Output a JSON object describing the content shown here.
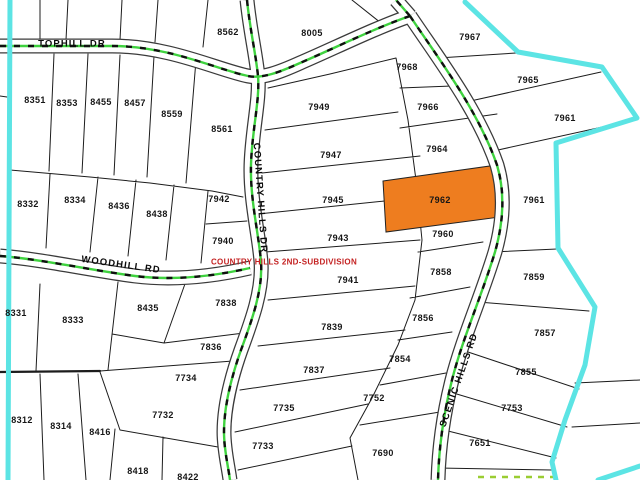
{
  "map": {
    "background_color": "#ffffff",
    "parcel_line_color": "#1c1c1c",
    "road_fill_color": "#ffffff",
    "road_centerline_color": "#3fd23f",
    "boundary_color": "#5ce4e4",
    "highlight_color": "#ee7d1f",
    "highlighted_parcel": "7962",
    "subdivision_label": {
      "text": "COUNTRY HILLS 2ND-SUBDIVISION",
      "color": "#c42222"
    },
    "roads": [
      {
        "name": "TOPHILL DR",
        "label_x": 72,
        "label_y": 44,
        "angle": 0
      },
      {
        "name": "WOODHILL RD",
        "label_x": 121,
        "label_y": 265,
        "angle": 8
      },
      {
        "name": "COUNTRY HILLS DR",
        "label_x": 260,
        "label_y": 198,
        "angle": 86
      },
      {
        "name": "SCENIC HILLS RD",
        "label_x": 459,
        "label_y": 380,
        "angle": -71
      }
    ],
    "parcels": [
      {
        "id": "8351",
        "x": 35,
        "y": 100
      },
      {
        "id": "8353",
        "x": 67,
        "y": 103
      },
      {
        "id": "8455",
        "x": 101,
        "y": 102
      },
      {
        "id": "8457",
        "x": 135,
        "y": 103
      },
      {
        "id": "8559",
        "x": 172,
        "y": 114
      },
      {
        "id": "8561",
        "x": 222,
        "y": 129
      },
      {
        "id": "8562",
        "x": 228,
        "y": 32
      },
      {
        "id": "8005",
        "x": 312,
        "y": 33
      },
      {
        "id": "7967",
        "x": 470,
        "y": 37
      },
      {
        "id": "7968",
        "x": 407,
        "y": 67
      },
      {
        "id": "7966",
        "x": 428,
        "y": 107
      },
      {
        "id": "7965",
        "x": 528,
        "y": 80
      },
      {
        "id": "7964",
        "x": 437,
        "y": 149
      },
      {
        "id": "7961",
        "x": 565,
        "y": 118
      },
      {
        "id": "7962",
        "x": 440,
        "y": 200
      },
      {
        "id": "7961",
        "x": 534,
        "y": 200
      },
      {
        "id": "7960",
        "x": 443,
        "y": 234
      },
      {
        "id": "7949",
        "x": 319,
        "y": 107
      },
      {
        "id": "7947",
        "x": 331,
        "y": 155
      },
      {
        "id": "7945",
        "x": 333,
        "y": 200
      },
      {
        "id": "7943",
        "x": 338,
        "y": 238
      },
      {
        "id": "7941",
        "x": 348,
        "y": 280
      },
      {
        "id": "7942",
        "x": 219,
        "y": 199
      },
      {
        "id": "7940",
        "x": 223,
        "y": 241
      },
      {
        "id": "8332",
        "x": 28,
        "y": 204
      },
      {
        "id": "8334",
        "x": 75,
        "y": 200
      },
      {
        "id": "8436",
        "x": 119,
        "y": 206
      },
      {
        "id": "8438",
        "x": 157,
        "y": 214
      },
      {
        "id": "8331",
        "x": 16,
        "y": 313
      },
      {
        "id": "8333",
        "x": 73,
        "y": 320
      },
      {
        "id": "8435",
        "x": 148,
        "y": 308
      },
      {
        "id": "7838",
        "x": 226,
        "y": 303
      },
      {
        "id": "7836",
        "x": 211,
        "y": 347
      },
      {
        "id": "7734",
        "x": 186,
        "y": 378
      },
      {
        "id": "7732",
        "x": 163,
        "y": 415
      },
      {
        "id": "8312",
        "x": 22,
        "y": 420
      },
      {
        "id": "8314",
        "x": 61,
        "y": 426
      },
      {
        "id": "8416",
        "x": 100,
        "y": 432
      },
      {
        "id": "8418",
        "x": 138,
        "y": 471
      },
      {
        "id": "8422",
        "x": 188,
        "y": 477
      },
      {
        "id": "7839",
        "x": 332,
        "y": 327
      },
      {
        "id": "7837",
        "x": 314,
        "y": 370
      },
      {
        "id": "7735",
        "x": 284,
        "y": 408
      },
      {
        "id": "7733",
        "x": 263,
        "y": 446
      },
      {
        "id": "7690",
        "x": 383,
        "y": 453
      },
      {
        "id": "7752",
        "x": 374,
        "y": 398
      },
      {
        "id": "7854",
        "x": 400,
        "y": 359
      },
      {
        "id": "7856",
        "x": 423,
        "y": 318
      },
      {
        "id": "7858",
        "x": 441,
        "y": 272
      },
      {
        "id": "7859",
        "x": 534,
        "y": 277
      },
      {
        "id": "7857",
        "x": 545,
        "y": 333
      },
      {
        "id": "7855",
        "x": 526,
        "y": 372
      },
      {
        "id": "7753",
        "x": 512,
        "y": 408
      },
      {
        "id": "7651",
        "x": 480,
        "y": 443
      }
    ]
  }
}
